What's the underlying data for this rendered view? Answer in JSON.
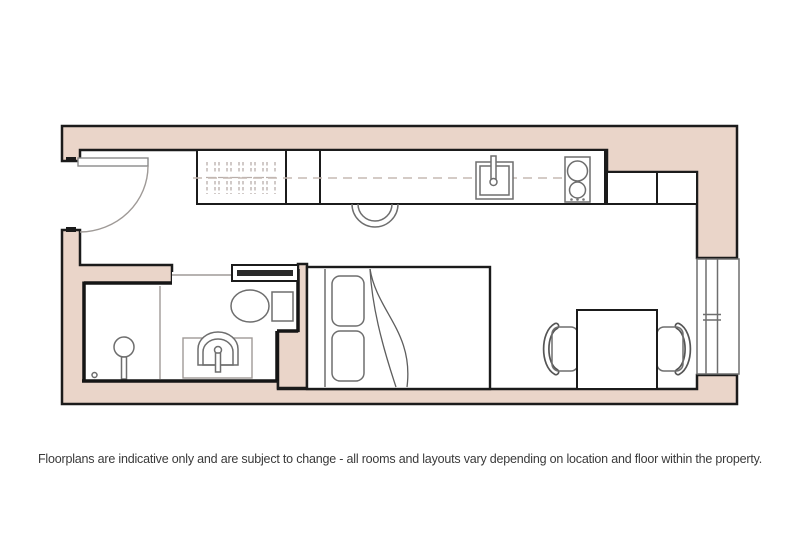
{
  "caption": "Floorplans are indicative only and are subject to change - all rooms and layouts vary depending on location and floor within the property.",
  "colors": {
    "background": "#ffffff",
    "wall_fill": "#ead5c9",
    "wall_line": "#1b1b1b",
    "fixture_line": "#6e6e6e",
    "light_line": "#9f9a97",
    "caption_text": "#3a3a3a"
  },
  "floorplan": {
    "type": "studio-apartment-floorplan",
    "rooms": [
      {
        "name": "studio-room"
      },
      {
        "name": "bathroom-pod"
      }
    ],
    "fixtures": [
      "entry-door",
      "wardrobe-with-hangers",
      "kitchen-cabinet",
      "kitchen-counter",
      "kitchen-sink",
      "hob-two-rings",
      "wall-cabinets",
      "counter-round-leaf",
      "sliding-bathroom-door",
      "shower-area",
      "shower-head",
      "wash-basin-vanity",
      "toilet",
      "bed-with-pillows",
      "duvet-fold",
      "dining-table",
      "dining-chair-left",
      "dining-chair-right",
      "window"
    ]
  }
}
